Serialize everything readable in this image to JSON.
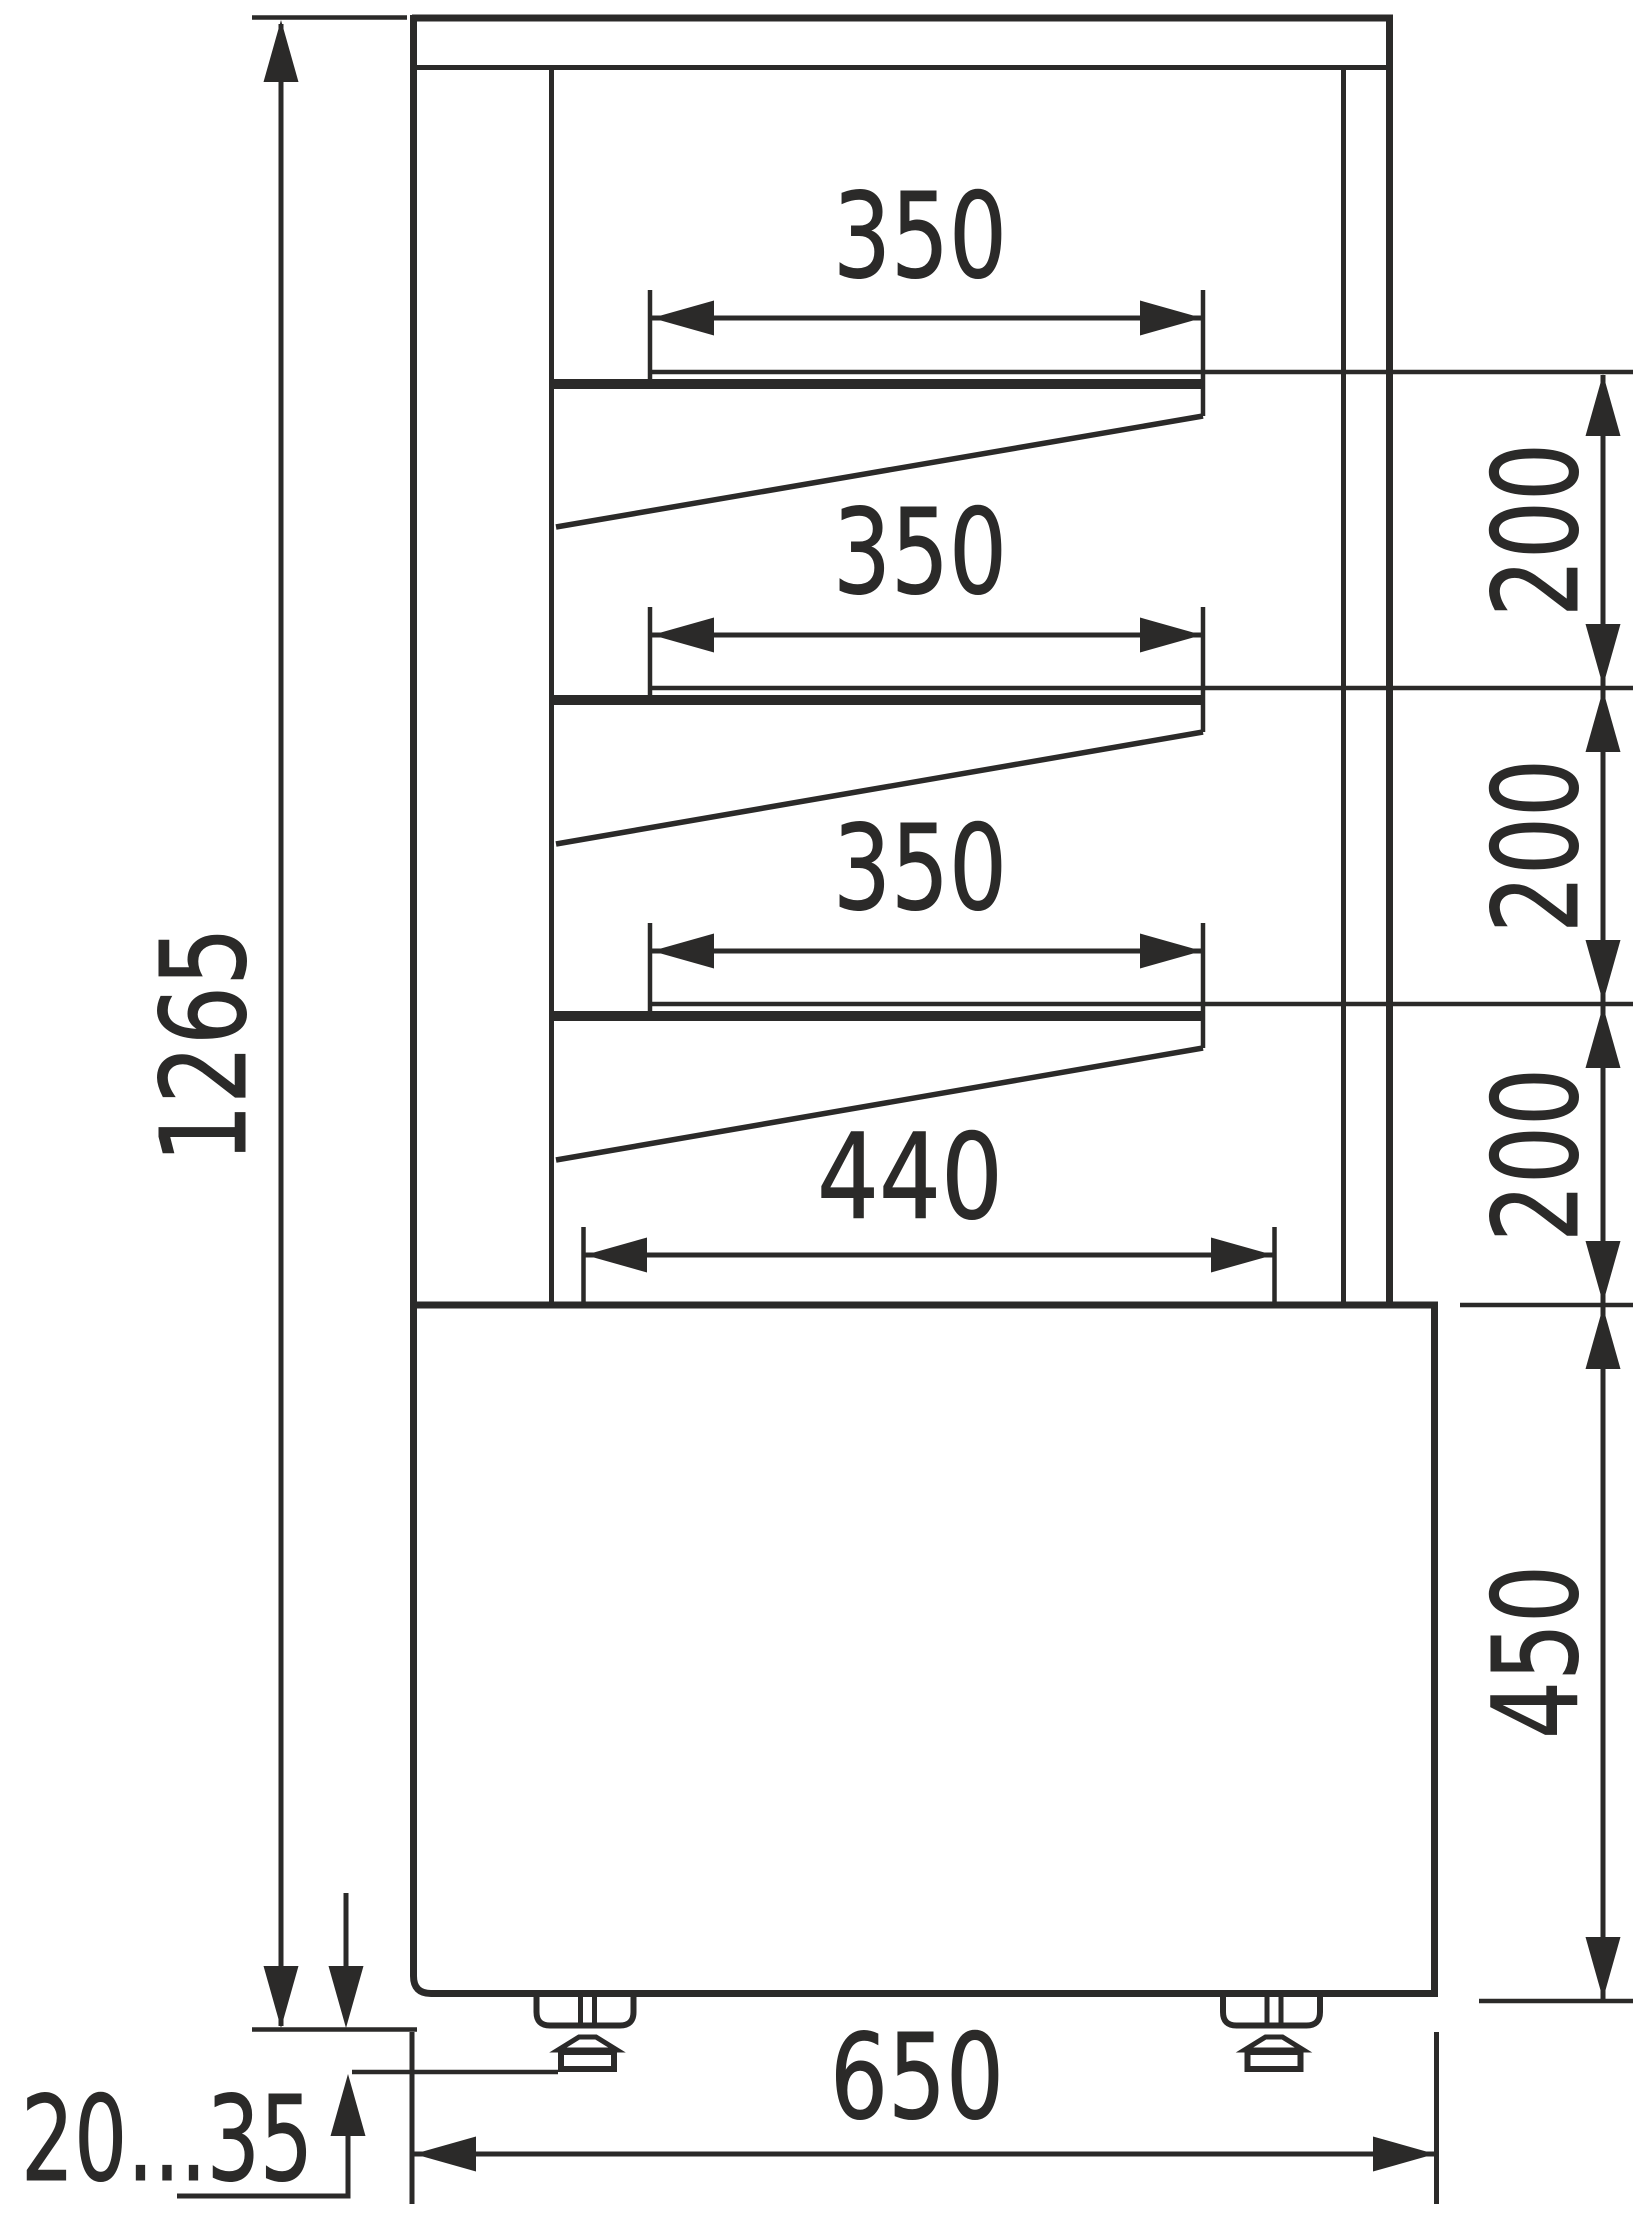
{
  "drawing": {
    "type": "technical-dimension-drawing",
    "subject": "display-case-side-section",
    "ink_color": "#2b2a29",
    "background_color": "#ffffff"
  },
  "dims": {
    "overall_height": "1265",
    "shelf1_width": "350",
    "shelf2_width": "350",
    "shelf3_width": "350",
    "shelf_gap1": "200",
    "shelf_gap2": "200",
    "shelf_gap3": "200",
    "bottom_shelf_width": "440",
    "base_height": "450",
    "overall_depth": "650",
    "foot_adjust_range": "20...35"
  }
}
